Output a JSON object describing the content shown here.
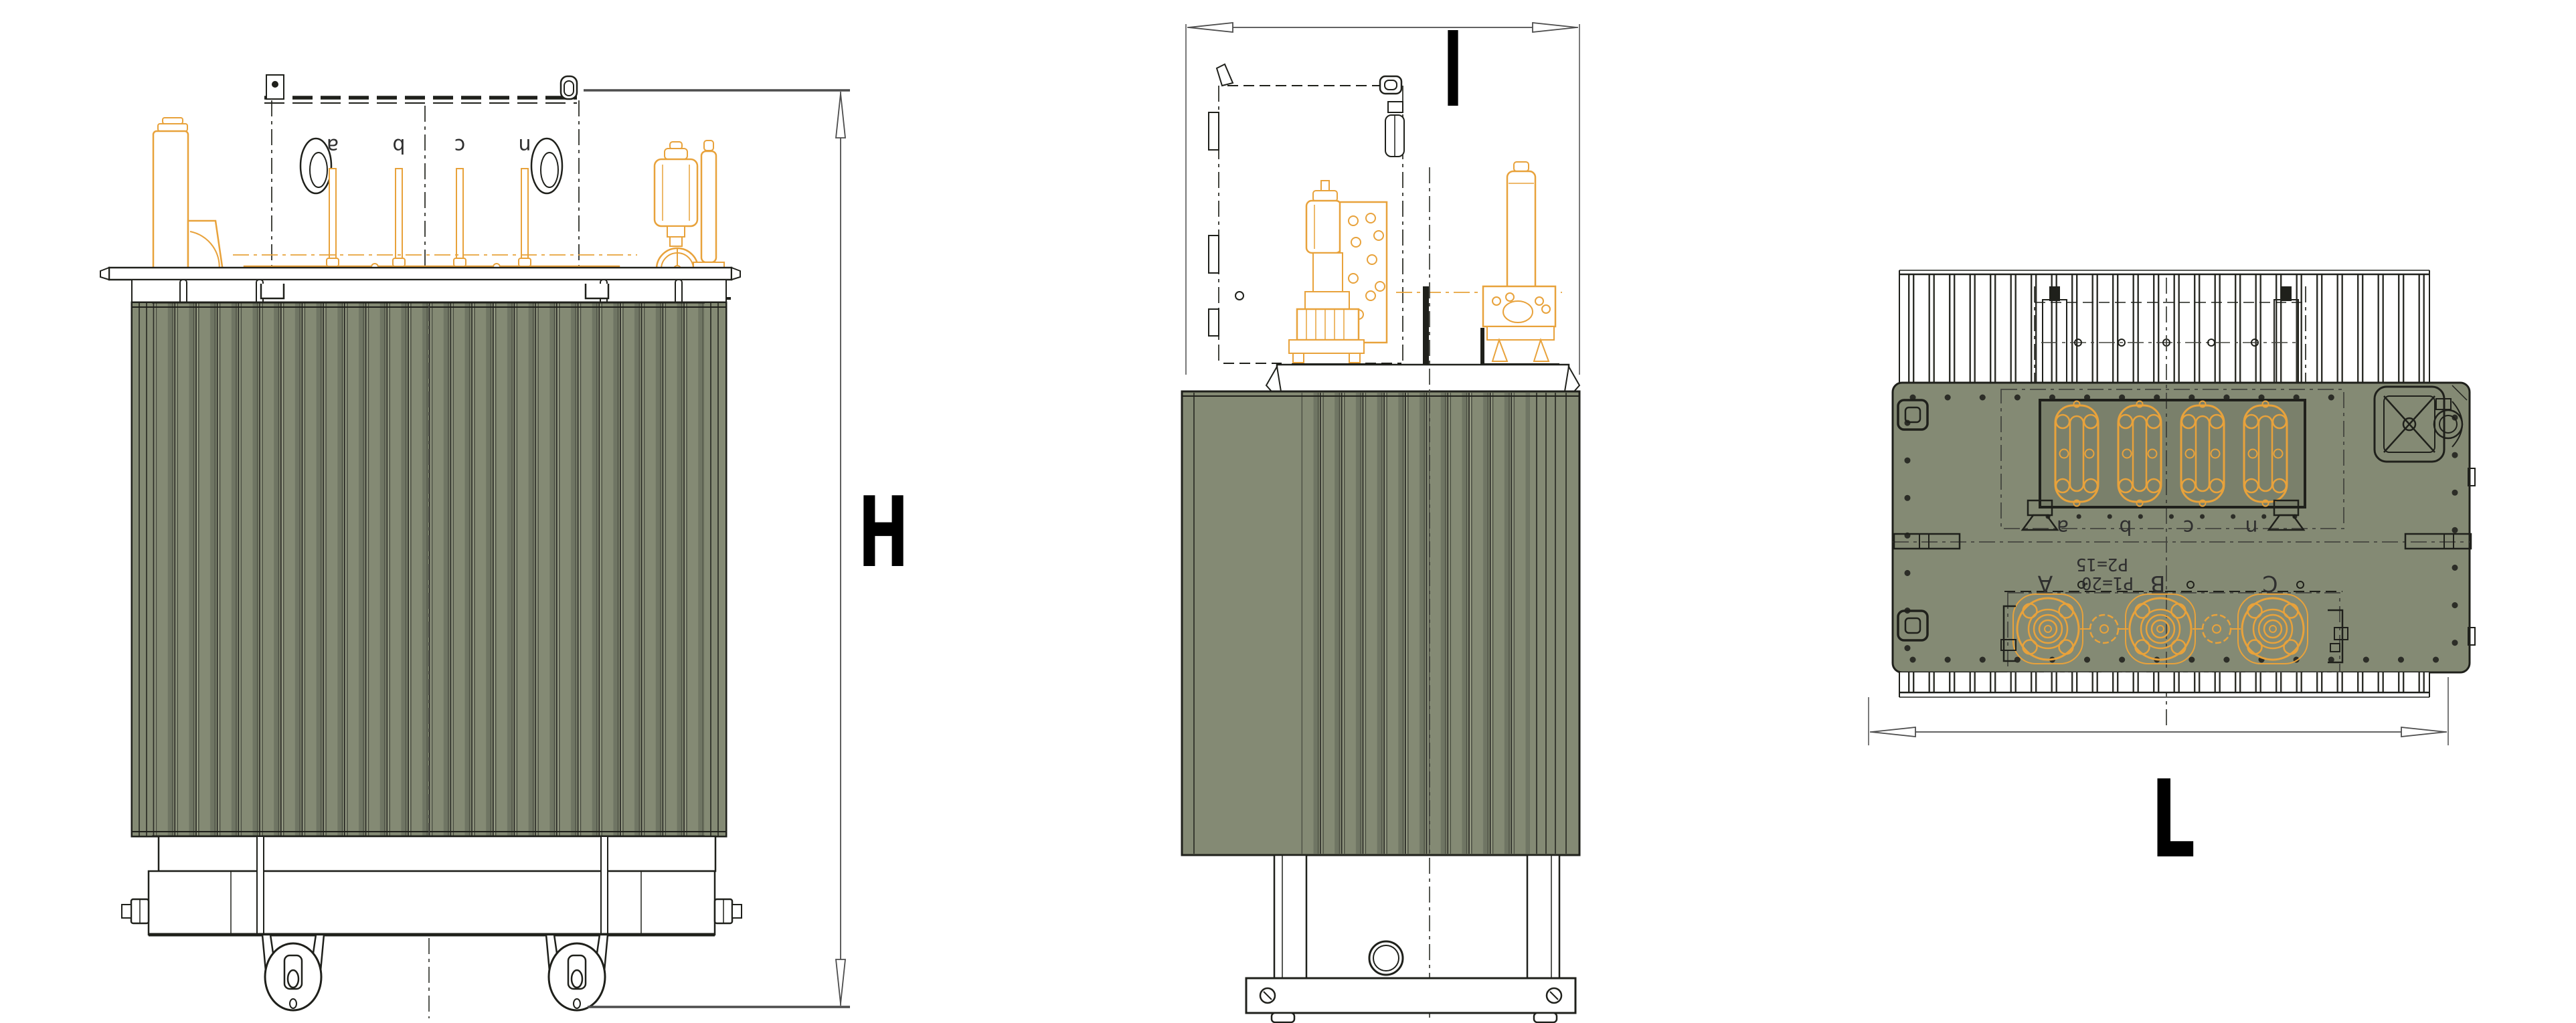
{
  "dimension_labels": {
    "height": "H",
    "depth": "I",
    "length": "L"
  },
  "front_view": {
    "lv_terminal_labels": [
      "a",
      "b",
      "c",
      "n"
    ]
  },
  "top_view": {
    "lv_terminal_labels": [
      "a",
      "b",
      "c",
      "n"
    ],
    "hv_terminal_labels": [
      "A",
      "B",
      "C"
    ],
    "tap_annotations": [
      "P2=15",
      "P1=20"
    ]
  },
  "colors": {
    "tank_fill": "#848A74",
    "tank_highlight": "#9CA28A",
    "tank_shadow": "#6F7563",
    "fin_line": "#2C2D27",
    "fin_line2": "#474B3F",
    "outline": "#1F201B",
    "accessory_orange": "#E8A23B",
    "dimension_line": "#4D4D4D",
    "centerline_color": "#44453F",
    "label_color": "#000000",
    "annotation_color": "#2F2F2F"
  }
}
